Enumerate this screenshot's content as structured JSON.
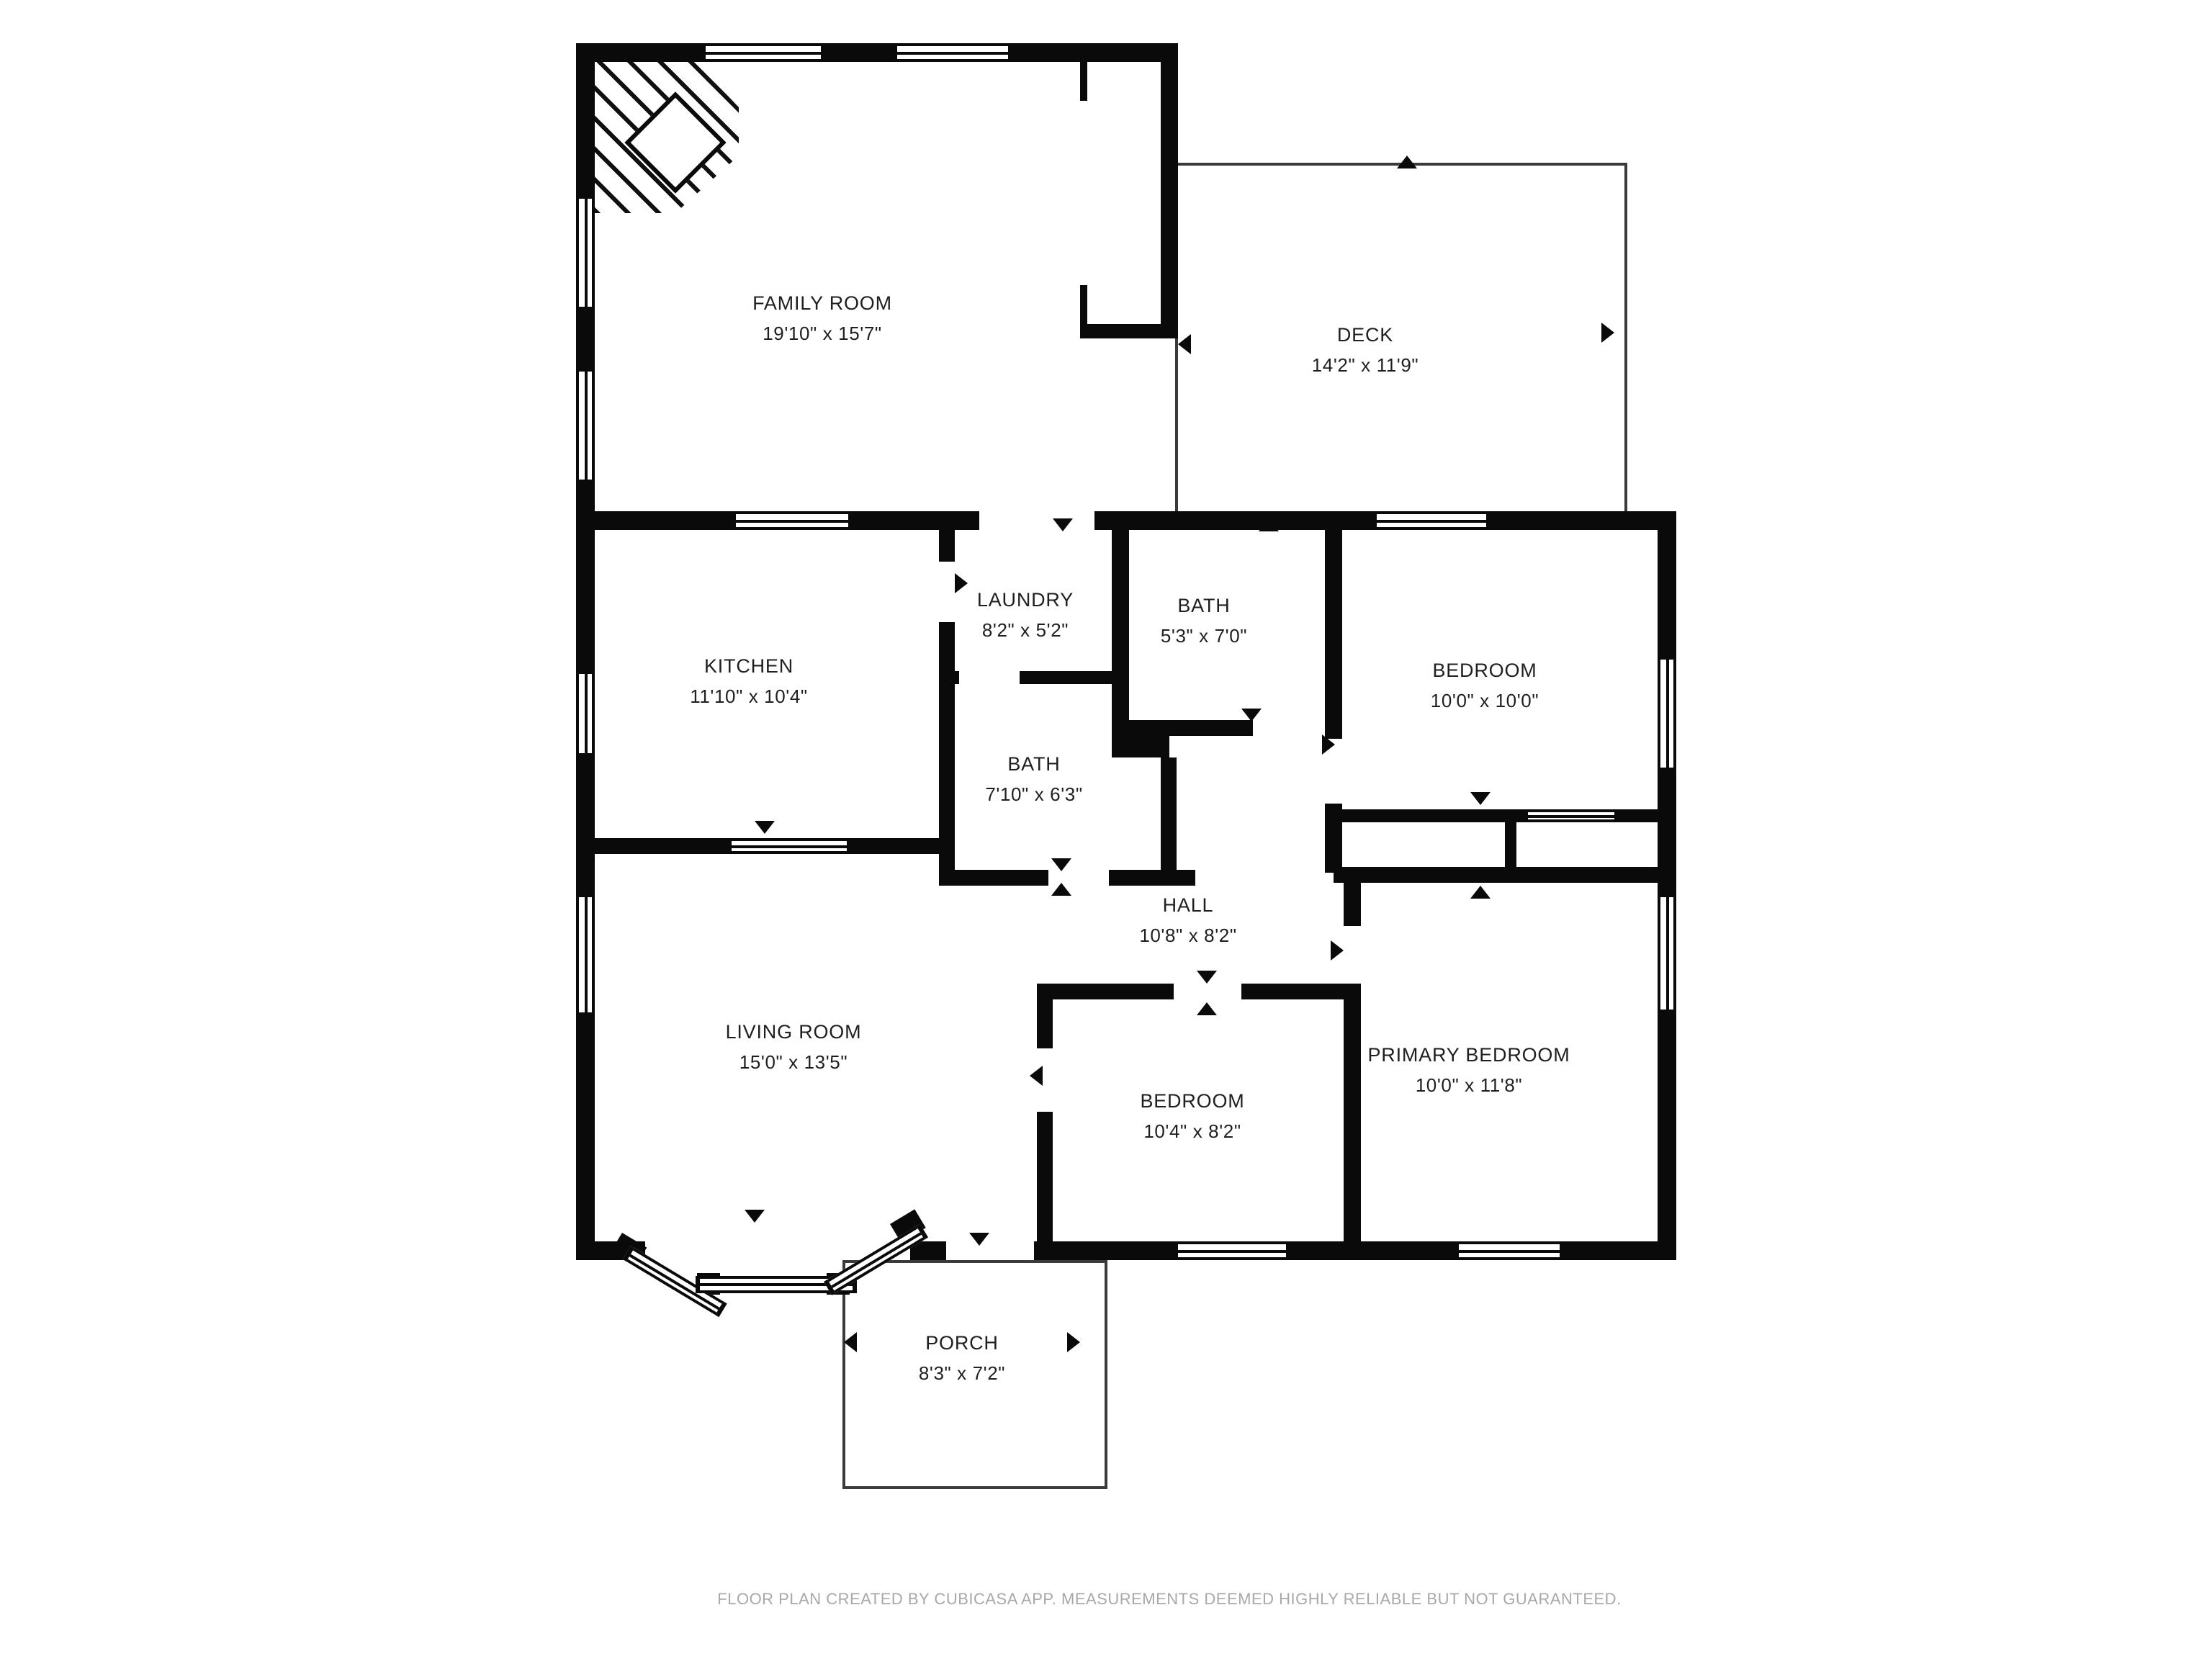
{
  "plan_title": "Residential floor plan",
  "rooms": [
    {
      "id": "family-room",
      "name": "FAMILY ROOM",
      "dimensions": "19'10\" x 15'7\""
    },
    {
      "id": "deck",
      "name": "DECK",
      "dimensions": "14'2\" x 11'9\""
    },
    {
      "id": "kitchen",
      "name": "KITCHEN",
      "dimensions": "11'10\" x 10'4\""
    },
    {
      "id": "laundry",
      "name": "LAUNDRY",
      "dimensions": "8'2\" x 5'2\""
    },
    {
      "id": "bath-upper",
      "name": "BATH",
      "dimensions": "5'3\" x 7'0\""
    },
    {
      "id": "bedroom-upper",
      "name": "BEDROOM",
      "dimensions": "10'0\" x 10'0\""
    },
    {
      "id": "bath-middle",
      "name": "BATH",
      "dimensions": "7'10\" x 6'3\""
    },
    {
      "id": "hall",
      "name": "HALL",
      "dimensions": "10'8\" x 8'2\""
    },
    {
      "id": "living-room",
      "name": "LIVING ROOM",
      "dimensions": "15'0\" x 13'5\""
    },
    {
      "id": "bedroom-lower",
      "name": "BEDROOM",
      "dimensions": "10'4\" x 8'2\""
    },
    {
      "id": "primary-bedroom",
      "name": "PRIMARY BEDROOM",
      "dimensions": "10'0\" x 11'8\""
    },
    {
      "id": "porch",
      "name": "PORCH",
      "dimensions": "8'3\" x 7'2\""
    }
  ],
  "footer": {
    "text": "FLOOR PLAN CREATED BY CUBICASA APP. MEASUREMENTS DEEMED HIGHLY RELIABLE BUT NOT GUARANTEED."
  },
  "colors": {
    "wall": "#0a0a0a",
    "label_text": "#1f1f1f",
    "footer_text": "#a8a8a8",
    "thin_outline": "#3a3a3a",
    "background": "#ffffff"
  }
}
